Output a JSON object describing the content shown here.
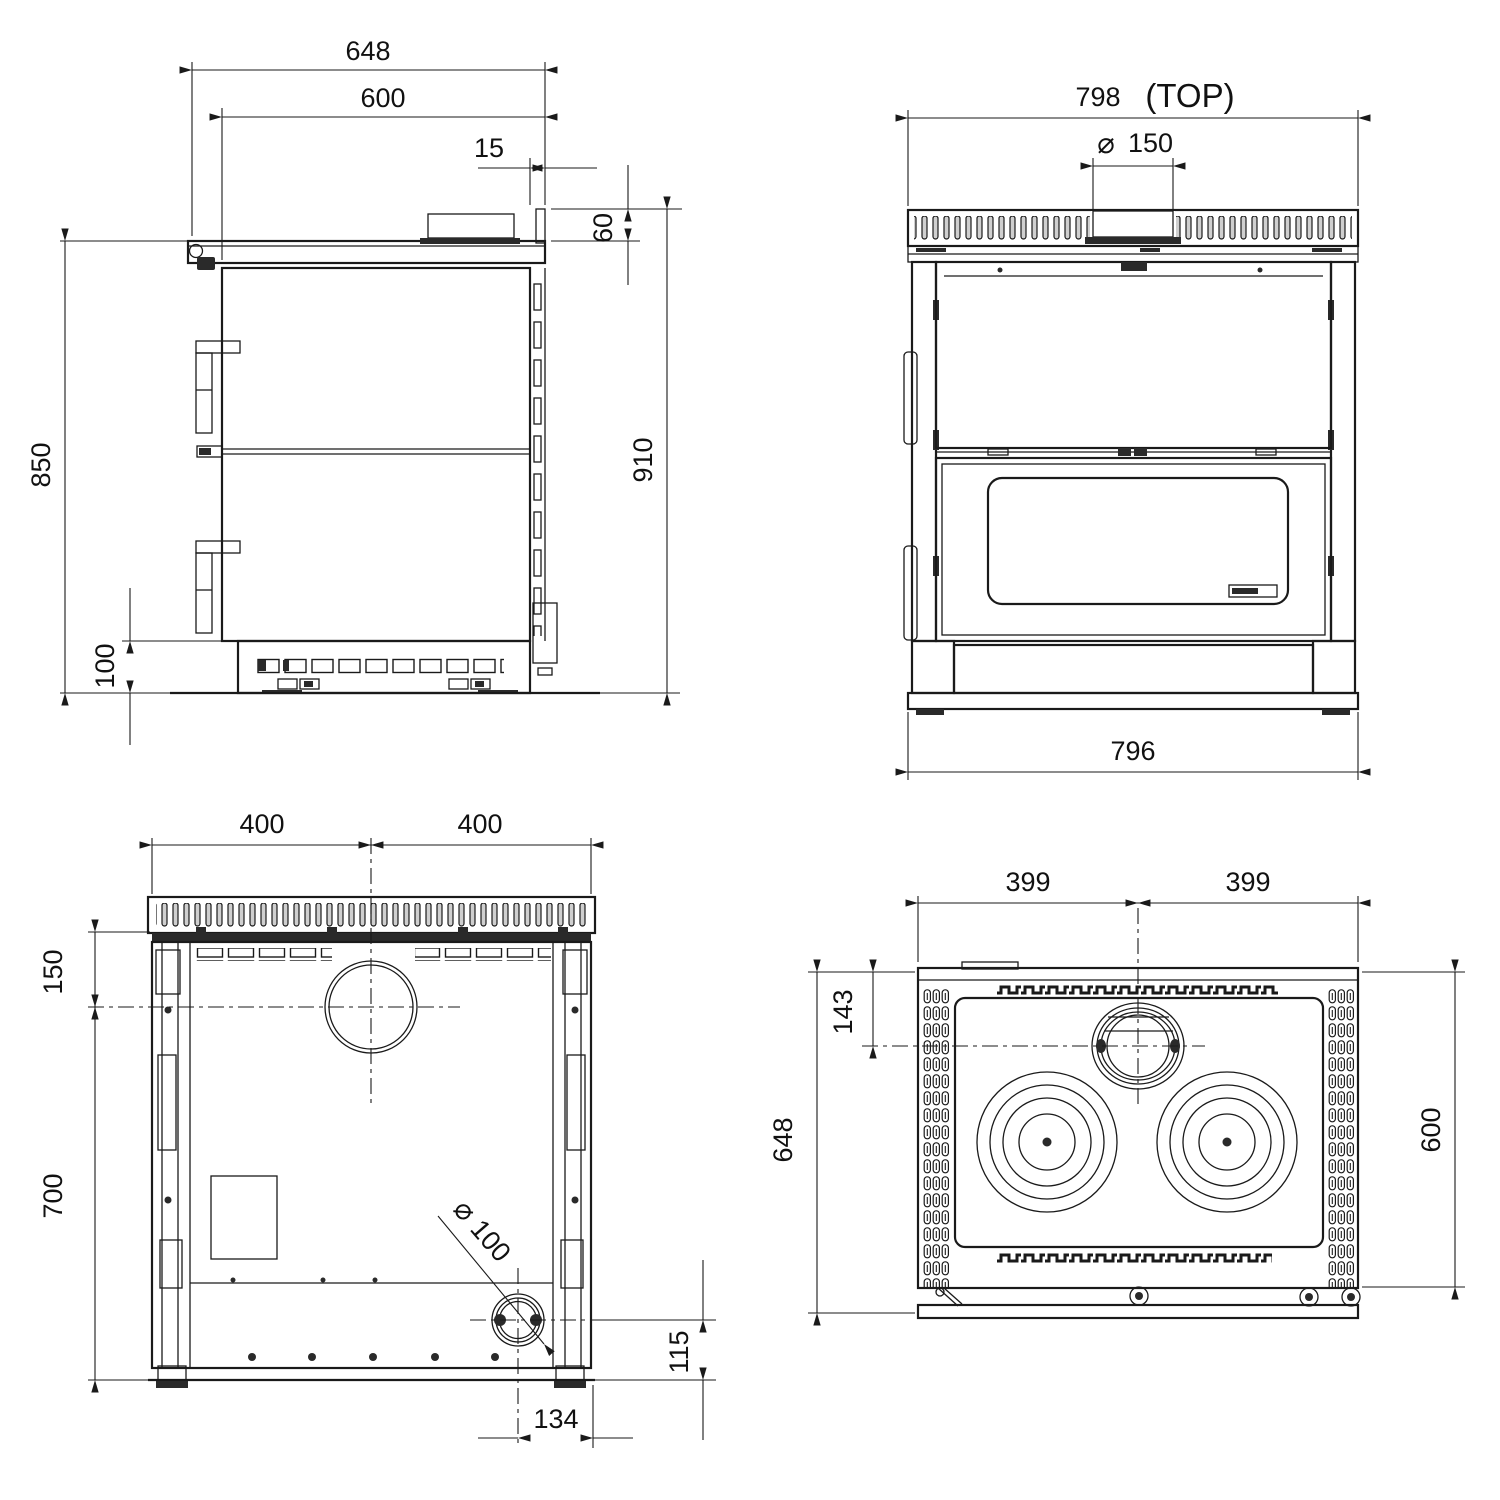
{
  "drawing": {
    "background": "#ffffff",
    "line_color": "#1a1a1a",
    "views": {
      "side": {
        "dim_depth_overall": "648",
        "dim_depth_body": "600",
        "dim_rear_lip": "15",
        "dim_top_thickness": "60",
        "dim_height_worktop": "850",
        "dim_height_overall": "910",
        "dim_plinth_height": "100"
      },
      "front": {
        "dim_width_top": "798",
        "top_tag": "(TOP)",
        "diameter_symbol": "⌀",
        "dim_flue_diameter": "150",
        "dim_width_base": "796"
      },
      "rear": {
        "dim_half_width_left": "400",
        "dim_half_width_right": "400",
        "dim_flue_center_from_top": "150",
        "dim_flue_center_to_floor": "700",
        "diameter_symbol": "⌀",
        "dim_outlet_diameter": "100",
        "dim_outlet_center_height": "115",
        "dim_outlet_center_from_edge": "134"
      },
      "top": {
        "dim_half_width_left": "399",
        "dim_half_width_right": "399",
        "dim_flue_center_from_rear": "143",
        "dim_depth_overall": "648",
        "dim_depth_cooktop": "600"
      }
    }
  }
}
